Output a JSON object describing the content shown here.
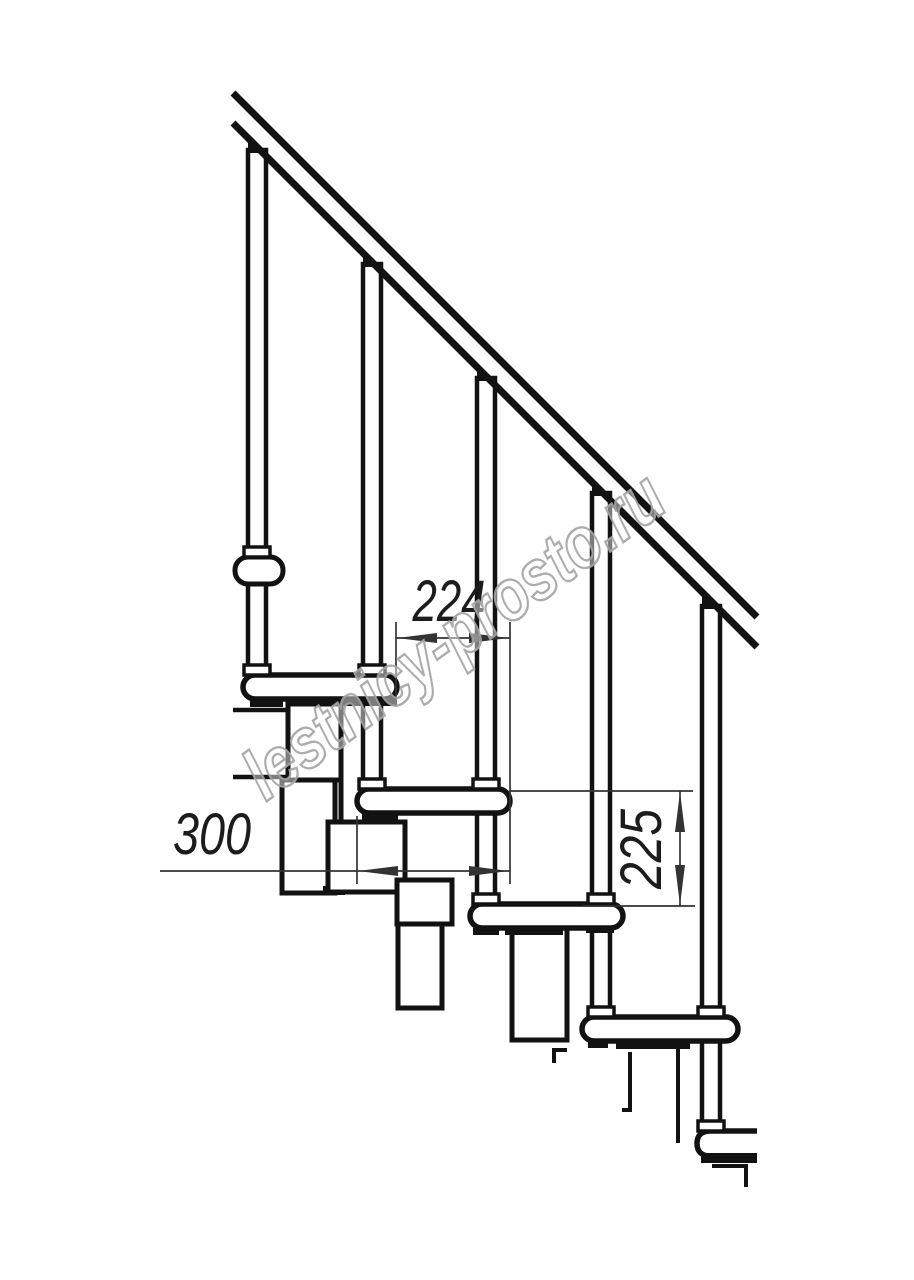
{
  "page": {
    "background": "#ffffff",
    "description": "Side-view technical drawing of a modular staircase fragment"
  },
  "drawing": {
    "ink_color": "#121212",
    "dimension_color": "#333333",
    "handrail_visible": true,
    "balusters_count": 5,
    "full_treads_count": 5,
    "end_on_landing_tread": true
  },
  "dimensions": [
    {
      "label": "224",
      "orientation": "horizontal"
    },
    {
      "label": "300",
      "orientation": "horizontal"
    },
    {
      "label": "225",
      "orientation": "vertical"
    }
  ],
  "watermark": {
    "text": "lestnicy-prosto.ru",
    "color": "#a3a3a3"
  }
}
